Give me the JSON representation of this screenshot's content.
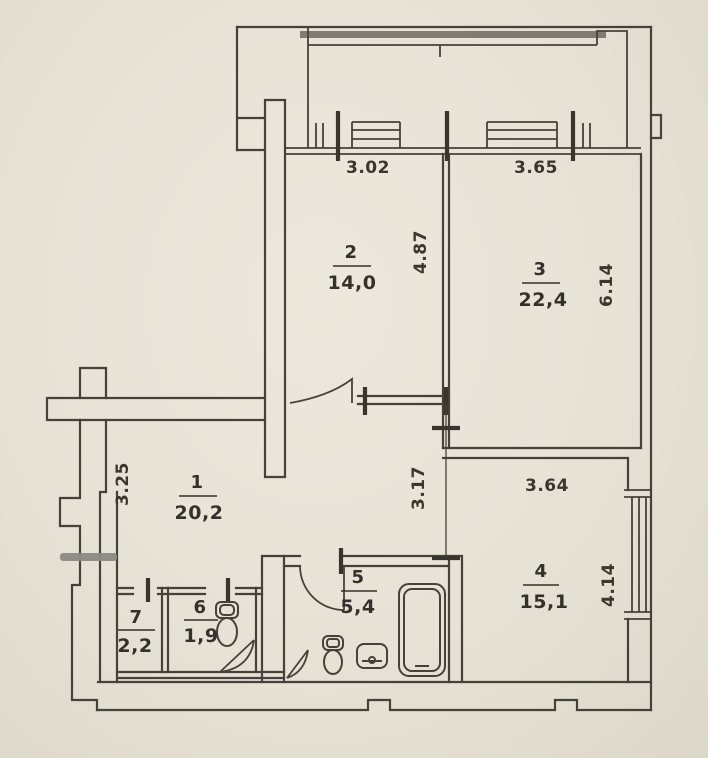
{
  "document": {
    "type": "apartment-floor-plan"
  },
  "colors": {
    "paper": "#e6e2d6",
    "ink": "#45423b",
    "text": "#33312b",
    "top_band_gray": "#6e6a60",
    "marker_gray": "#8a8a84"
  },
  "rooms": [
    {
      "number": "1",
      "area": "20,2"
    },
    {
      "number": "2",
      "area": "14,0"
    },
    {
      "number": "3",
      "area": "22,4"
    },
    {
      "number": "4",
      "area": "15,1"
    },
    {
      "number": "5",
      "area": "5,4"
    },
    {
      "number": "6",
      "area": "1,9"
    },
    {
      "number": "7",
      "area": "2,2"
    }
  ],
  "dimensions": [
    {
      "label": "3.02",
      "orientation": "horizontal",
      "location": "room2-top"
    },
    {
      "label": "3.65",
      "orientation": "horizontal",
      "location": "room3-top"
    },
    {
      "label": "4.87",
      "orientation": "vertical",
      "location": "room2-right"
    },
    {
      "label": "6.14",
      "orientation": "vertical",
      "location": "room3-right"
    },
    {
      "label": "3.25",
      "orientation": "vertical",
      "location": "room1-left"
    },
    {
      "label": "3.17",
      "orientation": "vertical",
      "location": "corridor"
    },
    {
      "label": "3.64",
      "orientation": "horizontal",
      "location": "room4-top"
    },
    {
      "label": "4.14",
      "orientation": "vertical",
      "location": "room4-right"
    }
  ],
  "fixtures": [
    {
      "name": "bathtub"
    },
    {
      "name": "toilet-wc"
    },
    {
      "name": "toilet-bathroom"
    },
    {
      "name": "sink-bathroom"
    }
  ]
}
